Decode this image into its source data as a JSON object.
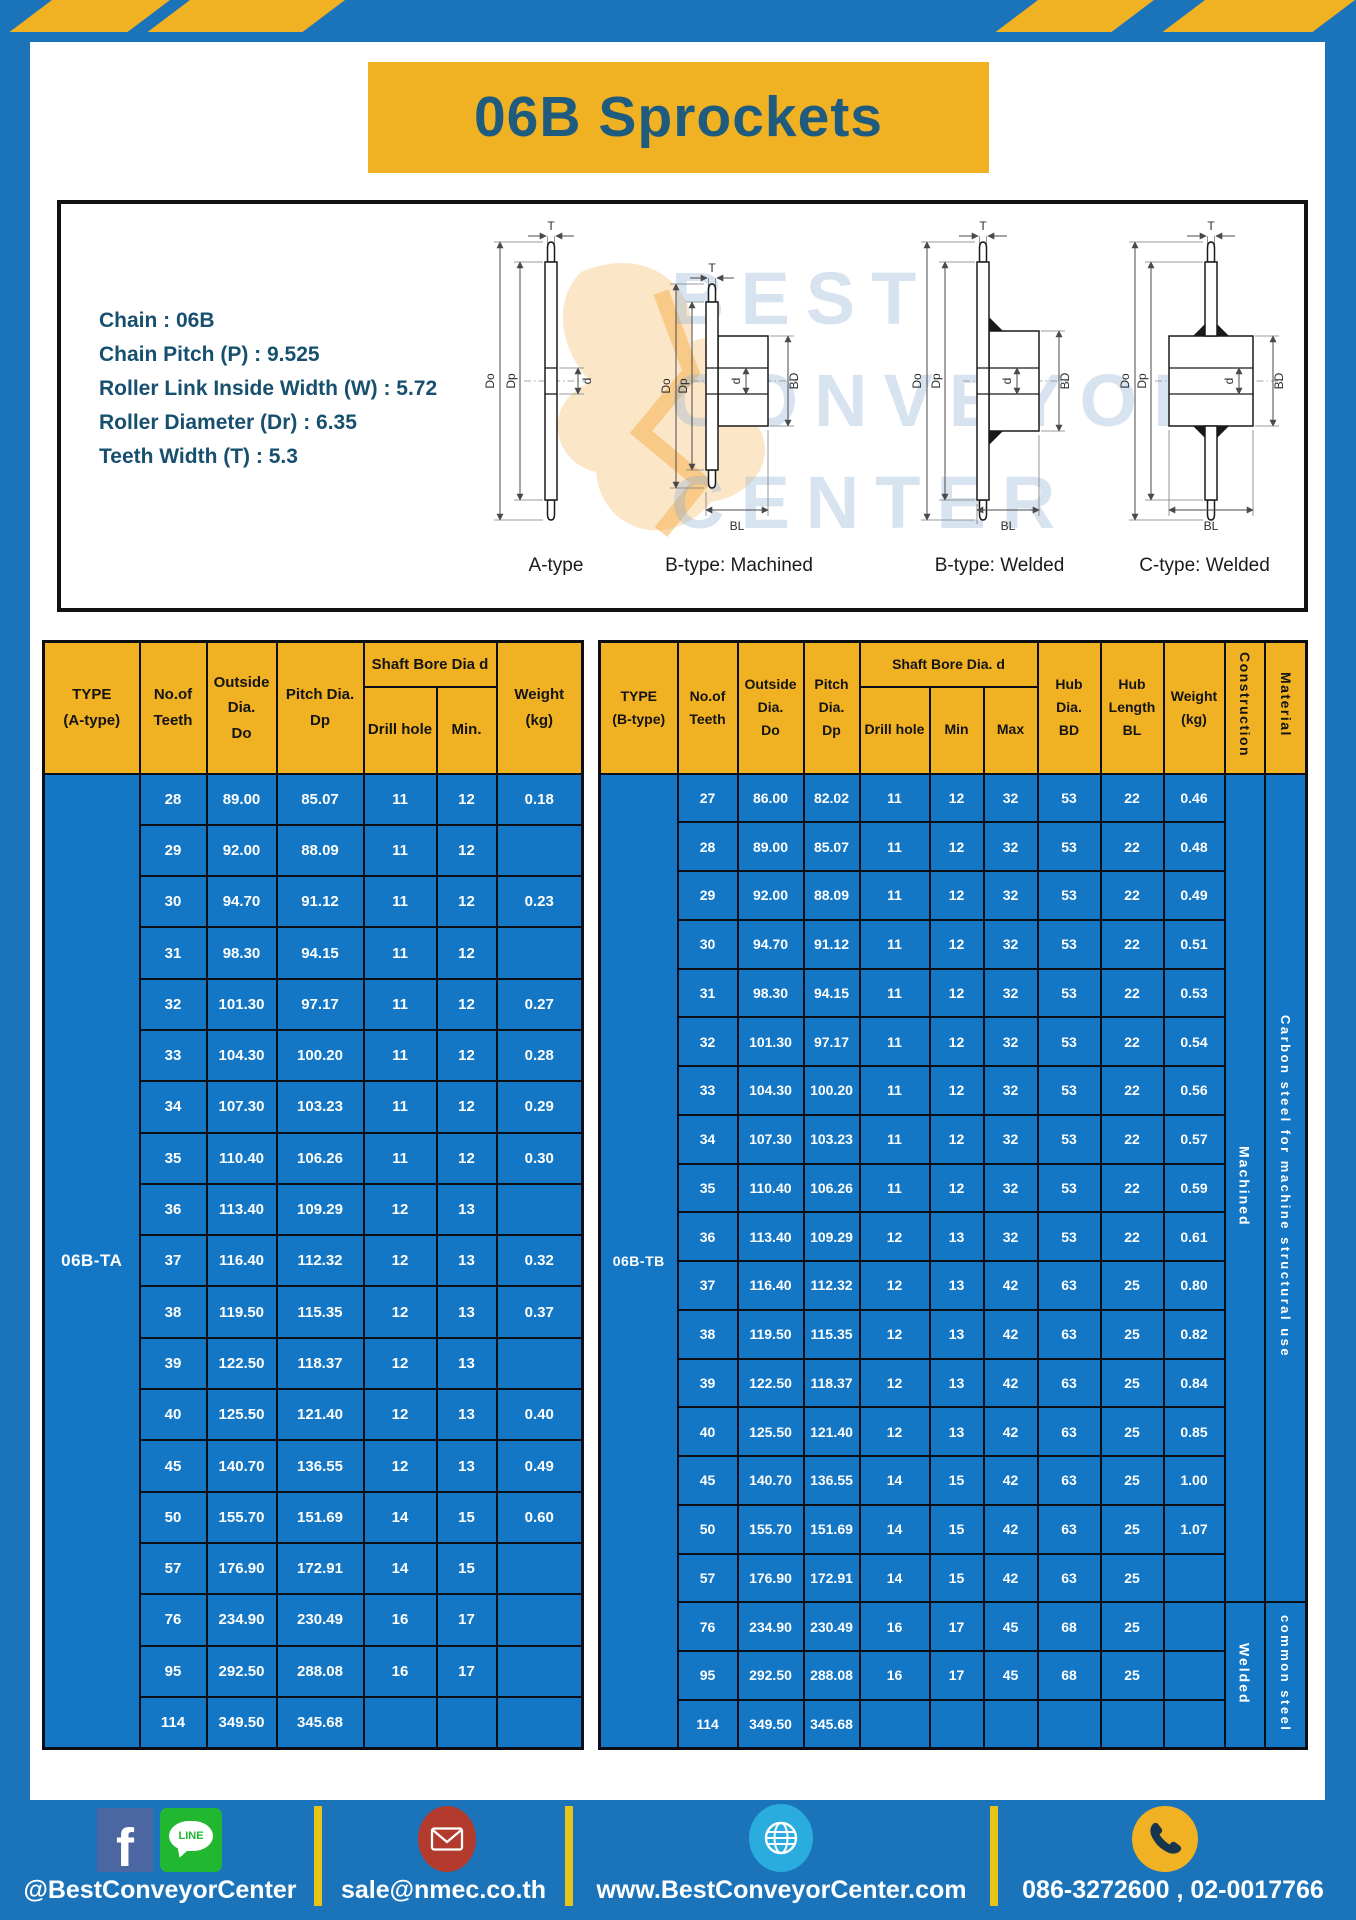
{
  "page": {
    "title": "06B Sprockets",
    "colors": {
      "frame_blue": "#1b74ba",
      "cell_blue": "#1377c6",
      "accent_yellow": "#f0b122",
      "title_text": "#1e5b7e",
      "facebook_blue": "#4b66a0",
      "line_green": "#21b731",
      "mail_red": "#b23b2d",
      "globe_blue": "#2bacdf"
    }
  },
  "specs": {
    "lines": [
      "Chain : 06B",
      "Chain Pitch (P) : 9.525",
      "Roller Link Inside Width (W) : 5.72",
      "Roller Diameter (Dr) : 6.35",
      "Teeth Width (T) : 5.3"
    ]
  },
  "diagrams": {
    "watermark_lines": [
      "BEST",
      "CONVEYOR",
      "CENTER"
    ],
    "captions": [
      "A-type",
      "B-type: Machined",
      "B-type: Welded",
      "C-type: Welded"
    ],
    "dim": {
      "T": "T",
      "Do": "Do",
      "Dp": "Dp",
      "d": "d",
      "BD": "BD",
      "BL": "BL"
    }
  },
  "table_a": {
    "headers": {
      "type": "TYPE\n(A-type)",
      "teeth": "No.of\nTeeth",
      "outside": "Outside\nDia.\nDo",
      "pitch": "Pitch Dia.\nDp",
      "shaft": "Shaft Bore Dia d",
      "drill": "Drill hole",
      "min": "Min.",
      "weight": "Weight\n(kg)"
    },
    "type_label": "06B-TA",
    "rows": [
      [
        "28",
        "89.00",
        "85.07",
        "11",
        "12",
        "0.18"
      ],
      [
        "29",
        "92.00",
        "88.09",
        "11",
        "12",
        ""
      ],
      [
        "30",
        "94.70",
        "91.12",
        "11",
        "12",
        "0.23"
      ],
      [
        "31",
        "98.30",
        "94.15",
        "11",
        "12",
        ""
      ],
      [
        "32",
        "101.30",
        "97.17",
        "11",
        "12",
        "0.27"
      ],
      [
        "33",
        "104.30",
        "100.20",
        "11",
        "12",
        "0.28"
      ],
      [
        "34",
        "107.30",
        "103.23",
        "11",
        "12",
        "0.29"
      ],
      [
        "35",
        "110.40",
        "106.26",
        "11",
        "12",
        "0.30"
      ],
      [
        "36",
        "113.40",
        "109.29",
        "12",
        "13",
        ""
      ],
      [
        "37",
        "116.40",
        "112.32",
        "12",
        "13",
        "0.32"
      ],
      [
        "38",
        "119.50",
        "115.35",
        "12",
        "13",
        "0.37"
      ],
      [
        "39",
        "122.50",
        "118.37",
        "12",
        "13",
        ""
      ],
      [
        "40",
        "125.50",
        "121.40",
        "12",
        "13",
        "0.40"
      ],
      [
        "45",
        "140.70",
        "136.55",
        "12",
        "13",
        "0.49"
      ],
      [
        "50",
        "155.70",
        "151.69",
        "14",
        "15",
        "0.60"
      ],
      [
        "57",
        "176.90",
        "172.91",
        "14",
        "15",
        ""
      ],
      [
        "76",
        "234.90",
        "230.49",
        "16",
        "17",
        ""
      ],
      [
        "95",
        "292.50",
        "288.08",
        "16",
        "17",
        ""
      ],
      [
        "114",
        "349.50",
        "345.68",
        "",
        "",
        ""
      ]
    ]
  },
  "table_b": {
    "headers": {
      "type": "TYPE\n(B-type)",
      "teeth": "No.of\nTeeth",
      "outside": "Outside\nDia.\nDo",
      "pitch": "Pitch\nDia.\nDp",
      "shaft": "Shaft Bore Dia. d",
      "drill": "Drill hole",
      "min": "Min",
      "max": "Max",
      "hub_dia": "Hub\nDia.\nBD",
      "hub_len": "Hub\nLength\nBL",
      "weight": "Weight\n(kg)",
      "construction": "Construction",
      "material": "Material"
    },
    "type_label": "06B-TB",
    "construction": [
      {
        "label": "Machined",
        "span": 17
      },
      {
        "label": "Welded",
        "span": 3
      }
    ],
    "material": [
      {
        "label": "Carbon steel for machine structural use",
        "span": 17
      },
      {
        "label": "common steel",
        "span": 3
      }
    ],
    "rows": [
      [
        "27",
        "86.00",
        "82.02",
        "11",
        "12",
        "32",
        "53",
        "22",
        "0.46"
      ],
      [
        "28",
        "89.00",
        "85.07",
        "11",
        "12",
        "32",
        "53",
        "22",
        "0.48"
      ],
      [
        "29",
        "92.00",
        "88.09",
        "11",
        "12",
        "32",
        "53",
        "22",
        "0.49"
      ],
      [
        "30",
        "94.70",
        "91.12",
        "11",
        "12",
        "32",
        "53",
        "22",
        "0.51"
      ],
      [
        "31",
        "98.30",
        "94.15",
        "11",
        "12",
        "32",
        "53",
        "22",
        "0.53"
      ],
      [
        "32",
        "101.30",
        "97.17",
        "11",
        "12",
        "32",
        "53",
        "22",
        "0.54"
      ],
      [
        "33",
        "104.30",
        "100.20",
        "11",
        "12",
        "32",
        "53",
        "22",
        "0.56"
      ],
      [
        "34",
        "107.30",
        "103.23",
        "11",
        "12",
        "32",
        "53",
        "22",
        "0.57"
      ],
      [
        "35",
        "110.40",
        "106.26",
        "11",
        "12",
        "32",
        "53",
        "22",
        "0.59"
      ],
      [
        "36",
        "113.40",
        "109.29",
        "12",
        "13",
        "32",
        "53",
        "22",
        "0.61"
      ],
      [
        "37",
        "116.40",
        "112.32",
        "12",
        "13",
        "42",
        "63",
        "25",
        "0.80"
      ],
      [
        "38",
        "119.50",
        "115.35",
        "12",
        "13",
        "42",
        "63",
        "25",
        "0.82"
      ],
      [
        "39",
        "122.50",
        "118.37",
        "12",
        "13",
        "42",
        "63",
        "25",
        "0.84"
      ],
      [
        "40",
        "125.50",
        "121.40",
        "12",
        "13",
        "42",
        "63",
        "25",
        "0.85"
      ],
      [
        "45",
        "140.70",
        "136.55",
        "14",
        "15",
        "42",
        "63",
        "25",
        "1.00"
      ],
      [
        "50",
        "155.70",
        "151.69",
        "14",
        "15",
        "42",
        "63",
        "25",
        "1.07"
      ],
      [
        "57",
        "176.90",
        "172.91",
        "14",
        "15",
        "42",
        "63",
        "25",
        ""
      ],
      [
        "76",
        "234.90",
        "230.49",
        "16",
        "17",
        "45",
        "68",
        "25",
        ""
      ],
      [
        "95",
        "292.50",
        "288.08",
        "16",
        "17",
        "45",
        "68",
        "25",
        ""
      ],
      [
        "114",
        "349.50",
        "345.68",
        "",
        "",
        "",
        "",
        "",
        ""
      ]
    ]
  },
  "footer": {
    "social_label": "@BestConveyorCenter",
    "email": "sale@nmec.co.th",
    "website": "www.BestConveyorCenter.com",
    "phones": "086-3272600 , 02-0017766",
    "facebook_letter": "f",
    "line_icon_text": "LINE"
  }
}
